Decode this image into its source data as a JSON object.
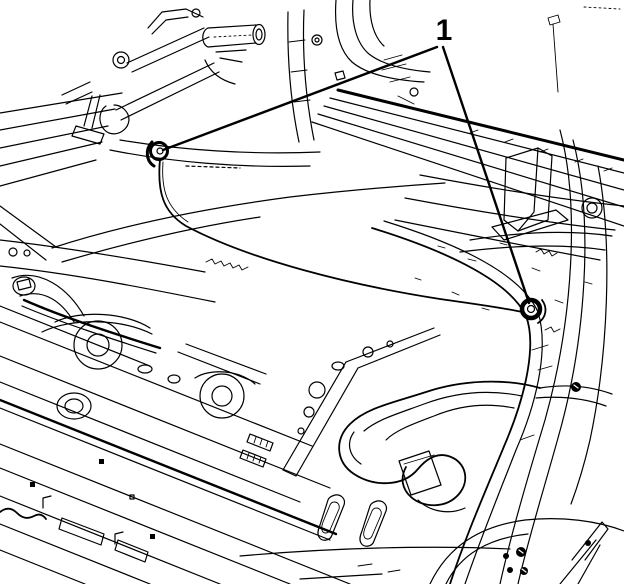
{
  "figure": {
    "background_color": "#ffffff",
    "line_color": "#000000",
    "description": "Black-and-white technical line illustration of a vehicle rear compartment floor viewed from the rear quarter: rear suspension components at top left, body rails, trunk hinge gooseneck bracket, spare wheel well, rocker sill and wheelhouse arch"
  },
  "callout": {
    "label": "1",
    "label_position": {
      "x": 444,
      "y": 38
    },
    "leader_apex": {
      "x": 440,
      "y": 46
    },
    "targets": [
      {
        "name": "left-grommet",
        "x": 159,
        "y": 151
      },
      {
        "name": "right-grommet",
        "x": 531,
        "y": 309
      }
    ]
  }
}
